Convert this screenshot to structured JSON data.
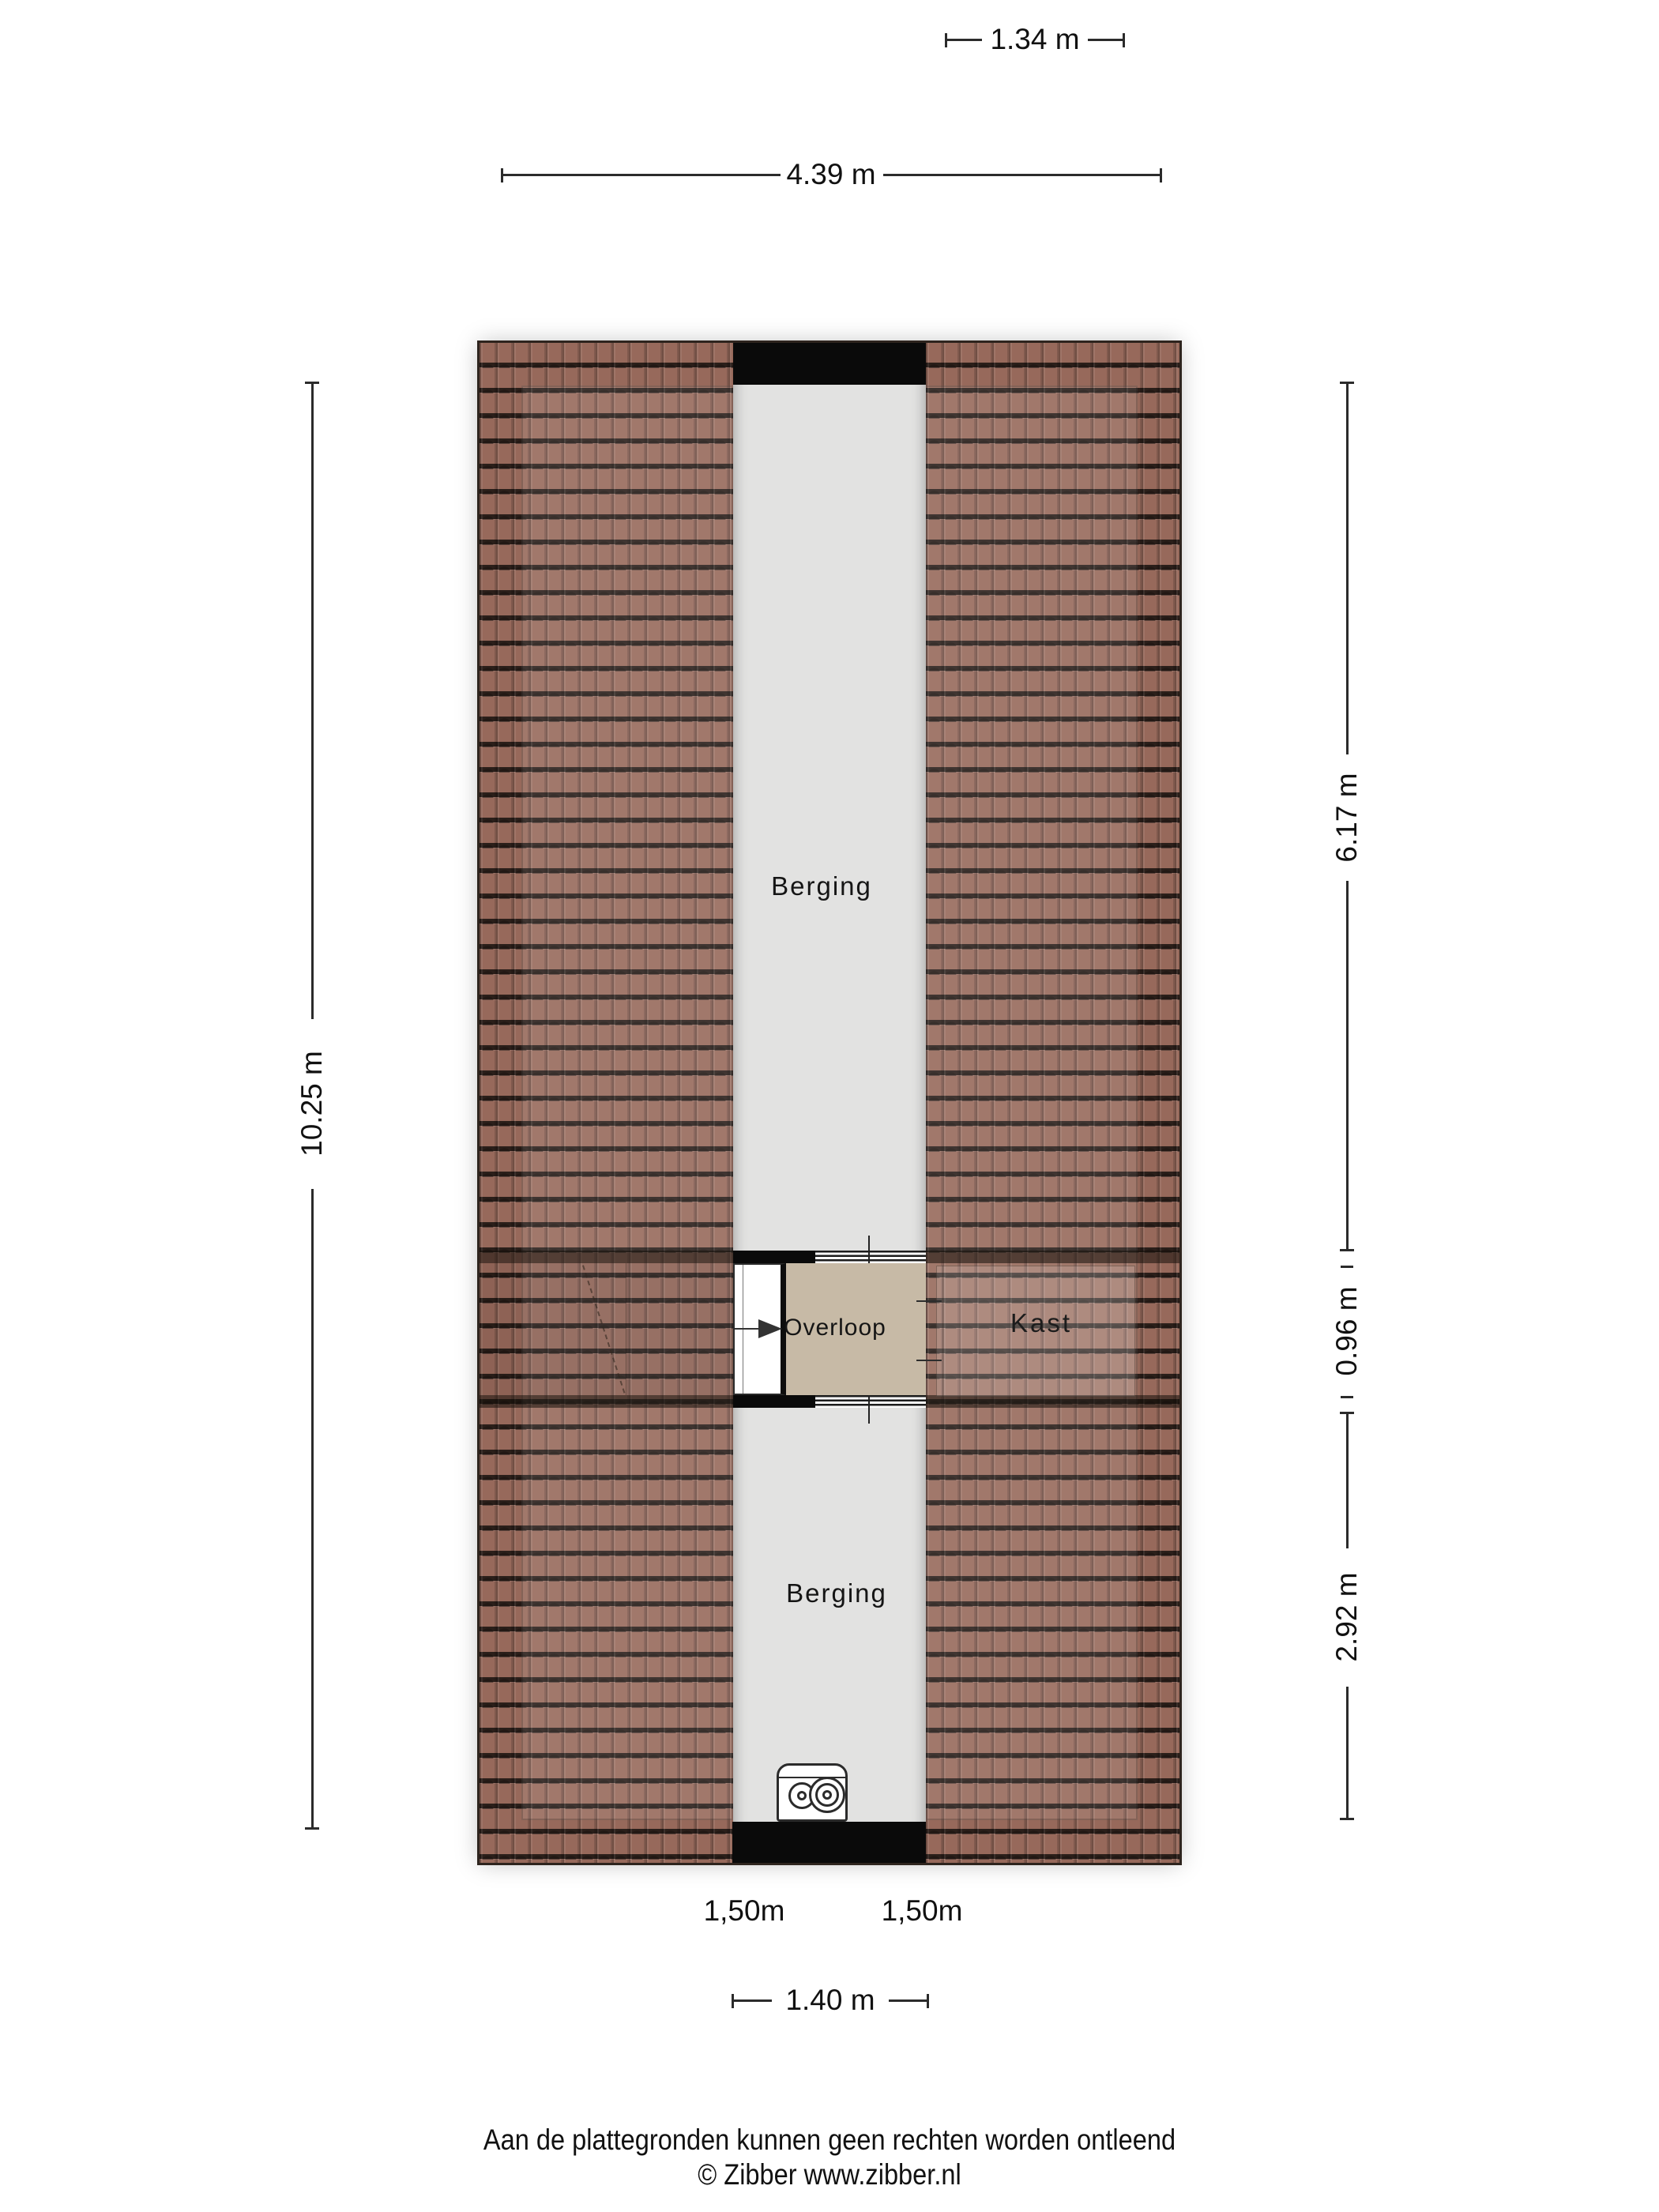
{
  "floorplan": {
    "rooms": {
      "berging_top": "Berging",
      "berging_bottom": "Berging",
      "overloop": "Overloop",
      "kast": "Kast"
    },
    "floor_labels": {
      "left": "1,50m",
      "right": "1,50m"
    }
  },
  "dimensions": {
    "top_inner": "1.34 m",
    "top_outer": "4.39 m",
    "left": "10.25 m",
    "right_upper": "6.17 m",
    "right_middle": "0.96 m",
    "right_lower": "2.92 m",
    "bottom": "1.40 m"
  },
  "footer": {
    "disclaimer": "Aan de plattegronden kunnen geen rechten worden ontleend",
    "copyright": "© Zibber www.zibber.nl"
  },
  "icons": {
    "stairs_arrow": "stairs-direction-arrow",
    "boiler": "boiler-icon"
  },
  "colors": {
    "roof": "#97695b",
    "corridor_floor": "#e2e2e1",
    "overloop_floor": "#c7baa6",
    "wall": "#0a0a0a",
    "dimension_text": "#111111"
  }
}
